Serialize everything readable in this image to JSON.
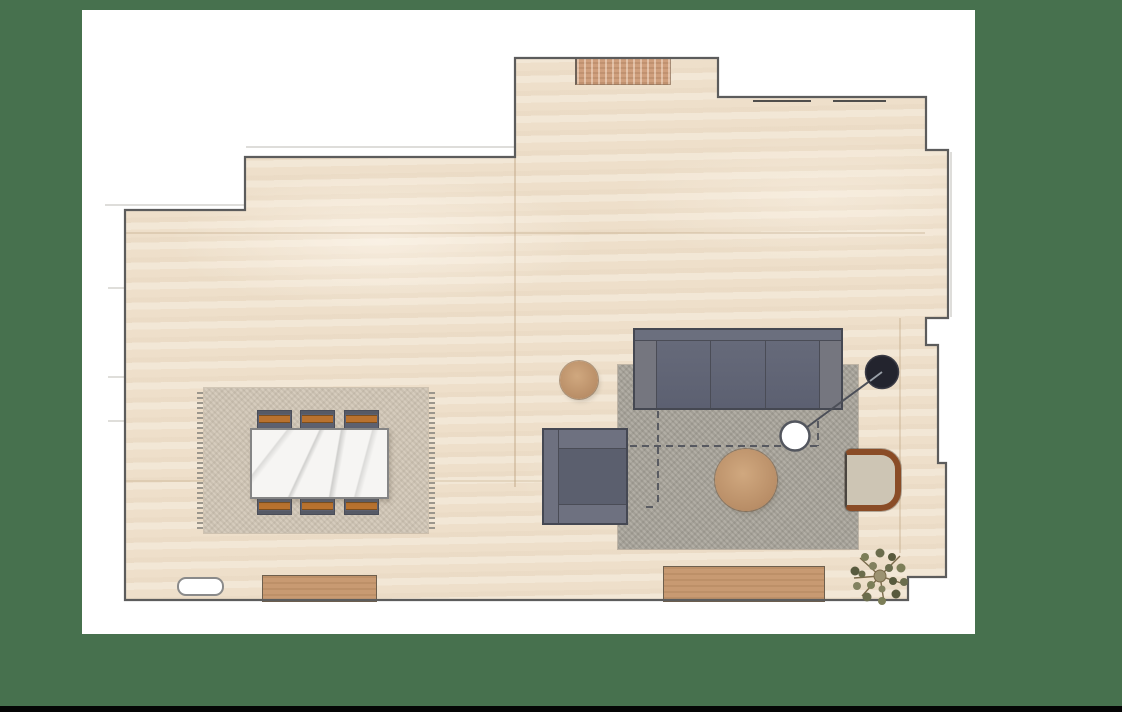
{
  "scene": {
    "type": "interior floor plan, top-down view",
    "background_color": "#47714E",
    "canvas_color": "#FFFFFF",
    "bottom_bar_color": "#050505",
    "floor_color": "#F0E3D0",
    "wall_color": "#5C5C5C"
  },
  "palette": {
    "sofa_gray": "#6A6E7D",
    "chair_gray": "#5D6170",
    "accent_orange": "#B9722F",
    "wood_tan": "#C79B75",
    "wood_frame_brown": "#8A4C26",
    "marble_white": "#F6F5F3",
    "dining_rug": "#D6CCBD",
    "living_rug": "#B2AEA5",
    "annotation_ink": "#4C4F58",
    "pin_black": "#23242E",
    "plant_olive": "#6F7050"
  },
  "objects": {
    "floor": {
      "label": "travertine-floor"
    },
    "walls": {
      "label": "room-walls"
    },
    "dining_rug": {
      "label": "fringed-dining-rug"
    },
    "dining_table": {
      "label": "marble-dining-table"
    },
    "dining_chair": {
      "label": "dining-chair",
      "count": 6
    },
    "entry_mat": {
      "label": "entry-doormat"
    },
    "sideboard": {
      "label": "low-sideboard"
    },
    "media_console": {
      "label": "media-console"
    },
    "floor_fixture": {
      "label": "recessed-floor-fixture"
    },
    "living_rug": {
      "label": "living-room-rug"
    },
    "sofa": {
      "label": "three-seat-sofa",
      "seats": 3
    },
    "armchair": {
      "label": "upholstered-armchair"
    },
    "accent_chair": {
      "label": "wood-frame-accent-chair"
    },
    "side_table": {
      "label": "round-side-table"
    },
    "coffee_table": {
      "label": "round-coffee-table"
    },
    "plant": {
      "label": "potted-plant"
    },
    "pin": {
      "label": "annotation-pin"
    },
    "marker": {
      "label": "placement-marker"
    },
    "dashed_outline": {
      "label": "proposed-footprint-outline"
    },
    "windows": {
      "label": "window-glazing-lines",
      "count": 2
    }
  }
}
